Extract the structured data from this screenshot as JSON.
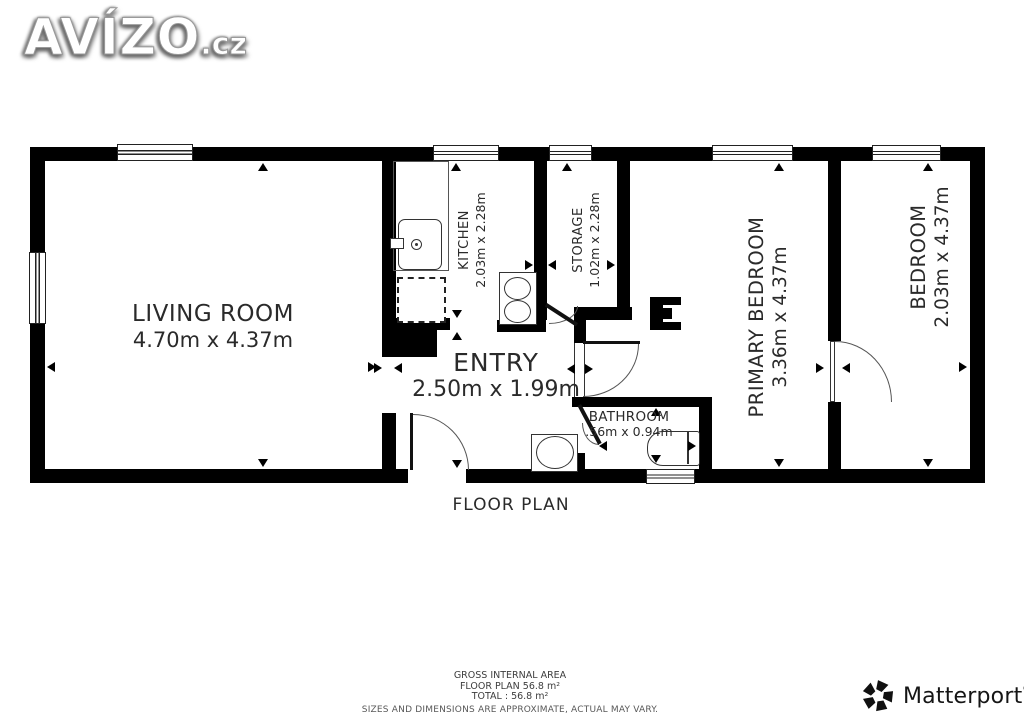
{
  "branding": {
    "avizo": {
      "name": "AVÍZO",
      "tld": ".cz"
    },
    "matterport": {
      "name": "Matterport",
      "reg": "®"
    }
  },
  "plan": {
    "caption": "FLOOR PLAN",
    "rooms": {
      "living_room": {
        "name": "LIVING ROOM",
        "dims": "4.70m x 4.37m"
      },
      "kitchen": {
        "name": "KITCHEN",
        "dims": "2.03m x 2.28m"
      },
      "storage": {
        "name": "STORAGE",
        "dims": "1.02m x 2.28m"
      },
      "entry": {
        "name": "ENTRY",
        "dims": "2.50m x 1.99m"
      },
      "bathroom": {
        "name": "BATHROOM",
        "dims": ".56m x 0.94m"
      },
      "primary_bedroom": {
        "name": "PRIMARY BEDROOM",
        "dims": "3.36m x 4.37m"
      },
      "bedroom": {
        "name": "BEDROOM",
        "dims": "2.03m x 4.37m"
      }
    }
  },
  "footer": {
    "line1": "GROSS INTERNAL AREA",
    "line2": "FLOOR PLAN 56.8 m²",
    "line3": "TOTAL :  56.8 m²",
    "disclaimer": "SIZES AND DIMENSIONS ARE APPROXIMATE, ACTUAL MAY VARY."
  },
  "colors": {
    "wall": "#000000",
    "text": "#2e2e2e",
    "background": "#ffffff"
  }
}
